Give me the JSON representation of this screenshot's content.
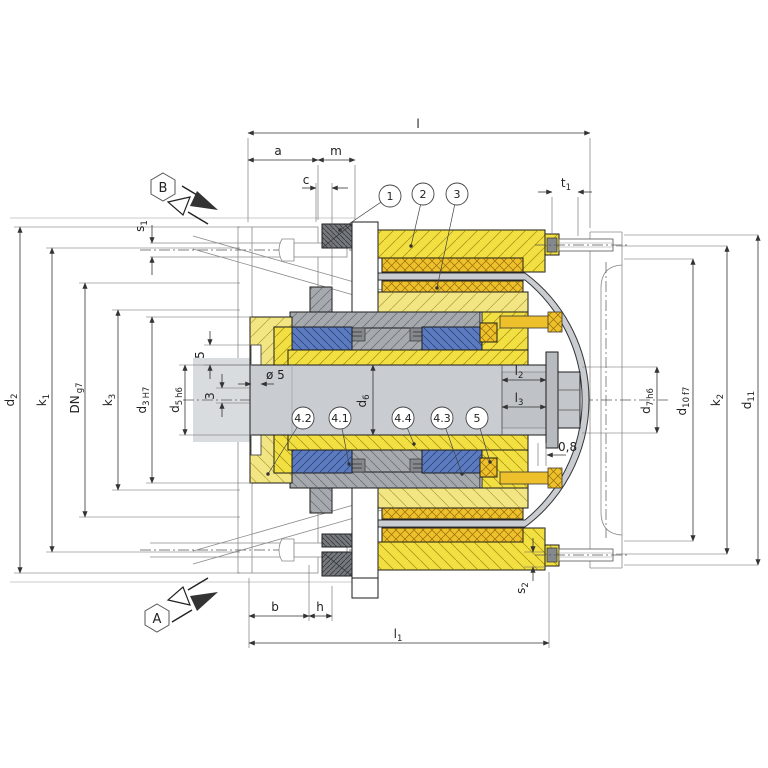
{
  "drawing": {
    "kind": "cross-section assembly drawing of a shaft coupling / electromagnetic clutch",
    "views": {
      "a": "A",
      "b": "B"
    }
  },
  "labels": {
    "l": "l",
    "a": "a",
    "m": "m",
    "c": "c",
    "b": "b",
    "h": "h",
    "t1b": "t",
    "t1s": "1",
    "s1b": "s",
    "s1s": "1",
    "s2b": "s",
    "s2s": "2",
    "l1b": "l",
    "l1s": "1",
    "l2b": "l",
    "l2s": "2",
    "l3b": "l",
    "l3s": "3",
    "d2b": "d",
    "d2s": "2",
    "k1b": "k",
    "k1s": "1",
    "dnb": "DN",
    "dnt": "g7",
    "k3b": "k",
    "k3s": "3",
    "d3b": "d",
    "d3s": "3",
    "d3t": "H7",
    "d5b": "d",
    "d5s": "5",
    "d5t": "h6",
    "d6b": "d",
    "d6s": "6",
    "d7b": "d",
    "d7s": "7",
    "d7t": "h6",
    "d10b": "d",
    "d10s": "10",
    "d10t": "f7",
    "k2b": "k",
    "k2s": "2",
    "d11b": "d",
    "d11s": "11",
    "dia5": "ø 5",
    "dim5": "5",
    "dim3": "3",
    "gap": "0,8"
  },
  "callouts": {
    "c1": "1",
    "c2": "2",
    "c3": "3",
    "c42": "4.2",
    "c41": "4.1",
    "c44": "4.4",
    "c43": "4.3",
    "c5": "5"
  },
  "colors": {
    "bright_yellow": "#f2df41",
    "pale_yellow": "#f2e583",
    "gold": "#eec02c",
    "blue": "#5b7abf",
    "gray_hub": "#a6aaae",
    "gray_dark": "#75797d",
    "shaft": "#c9cdd1",
    "shaft_end": "#bfc3c7",
    "band": "#c9ccd0",
    "washer": "#b7bbbf",
    "hex_head": "#c3c7cb",
    "phantom_shaft": "#d9dcdf",
    "white": "#ffffff"
  }
}
